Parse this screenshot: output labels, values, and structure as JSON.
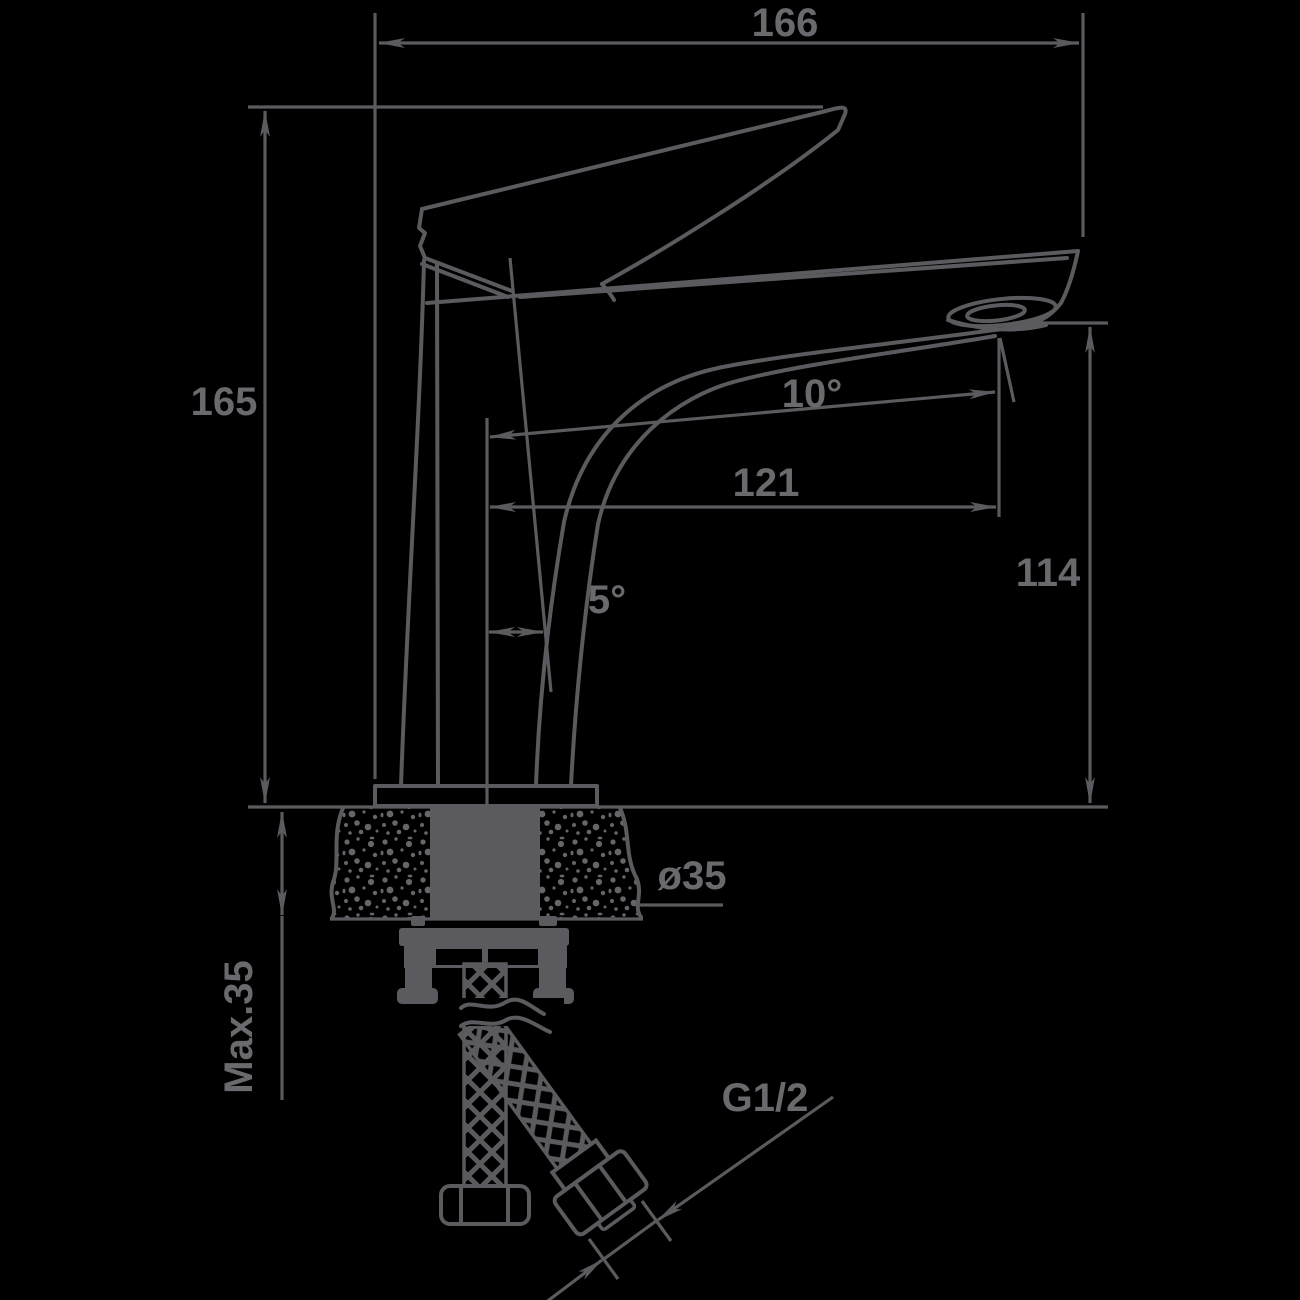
{
  "drawing": {
    "type": "technical-drawing",
    "subject": "Single-lever basin mixer faucet — side view with mounting cross-section",
    "colors": {
      "background": "#000000",
      "line": "#5b5b5f",
      "text": "#6a6a6e"
    },
    "dims": {
      "overall_width": "166",
      "overall_height": "165",
      "spout_angle": "10°",
      "spout_reach": "121",
      "spout_height": "114",
      "body_tilt": "5°",
      "hole_diameter": "ø35",
      "max_counter_thickness": "Max.35",
      "thread_size": "G1/2"
    }
  }
}
